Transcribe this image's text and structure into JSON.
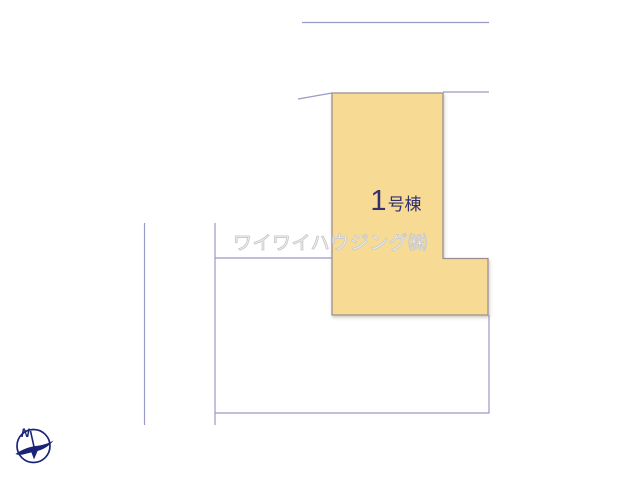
{
  "page": {
    "background_color": "#ffffff",
    "type": "real-estate site plan"
  },
  "site_plan": {
    "building_plot": {
      "label_number": "1",
      "label_suffix": "号棟",
      "fill_color": "#F7DB95",
      "border_color": "#9C8F92",
      "label_color": "#32306E"
    },
    "boundary_line_color": "#9A9AC8"
  },
  "watermark": {
    "text": "ワイワイハウジング㈱",
    "color": "#cccccc"
  },
  "compass": {
    "north_label": "N",
    "color": "#1B2377"
  }
}
